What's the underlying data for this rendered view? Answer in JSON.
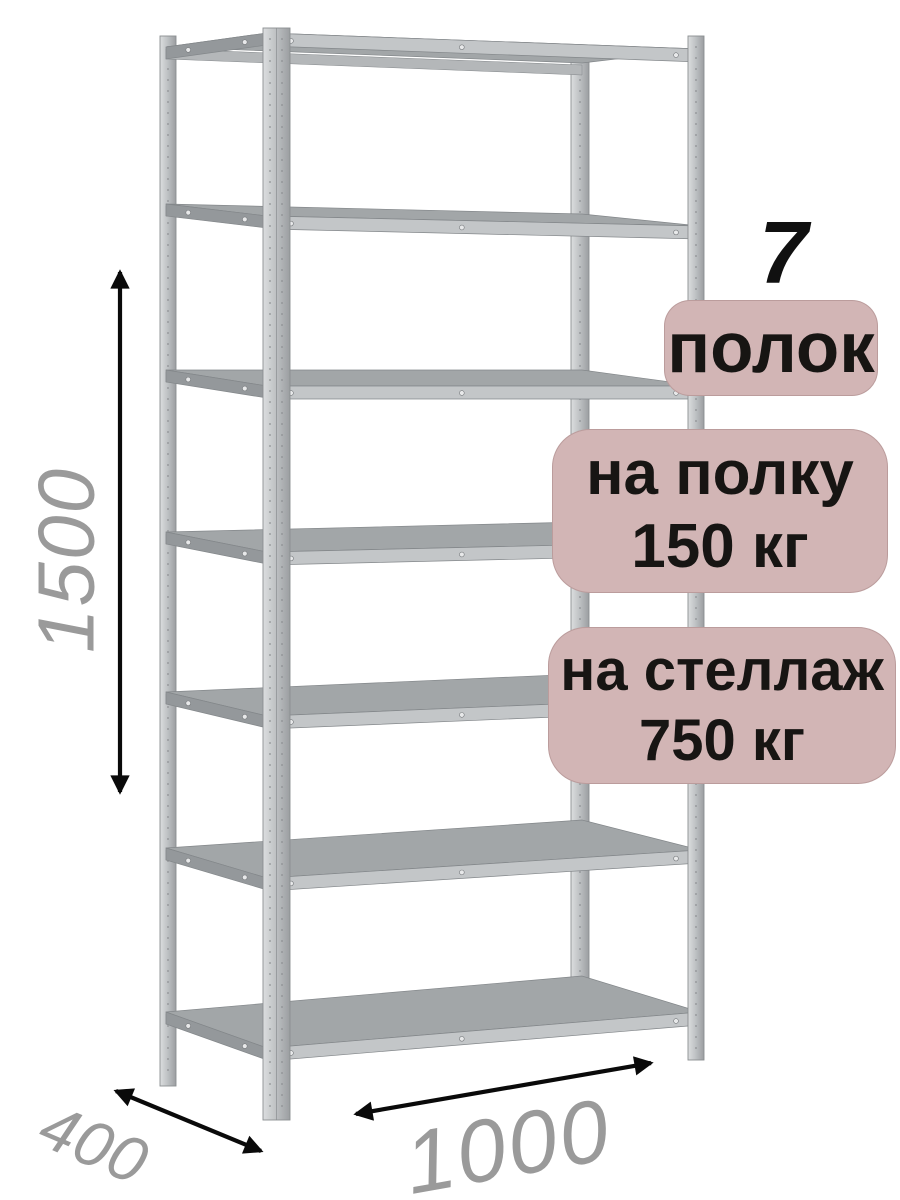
{
  "product": {
    "name": "metal-shelving-rack",
    "shelves_count": 7,
    "posts_count": 4
  },
  "dimensions": {
    "height": "1500",
    "depth": "400",
    "width": "1000"
  },
  "badges": {
    "count_number": "7",
    "count_label": "полок",
    "per_shelf_line1": "на полку",
    "per_shelf_line2": "150 кг",
    "per_rack_line1": "на стеллаж",
    "per_rack_line2": "750 кг"
  },
  "colors": {
    "background": "#ffffff",
    "badge_bg": "#d2b5b5",
    "badge_text": "#171513",
    "count_number_color": "#101010",
    "dimension_text": "#9a9a9a",
    "arrow": "#0a0a0a",
    "metal_light": "#dcdedf",
    "metal_mid": "#b4b7b9",
    "metal_dark": "#8b8e91",
    "shelf_top": "#a2a6a8",
    "shelf_edge": "#c3c6c8",
    "shelf_side": "#94989b",
    "screw": "#e8e9ea"
  }
}
